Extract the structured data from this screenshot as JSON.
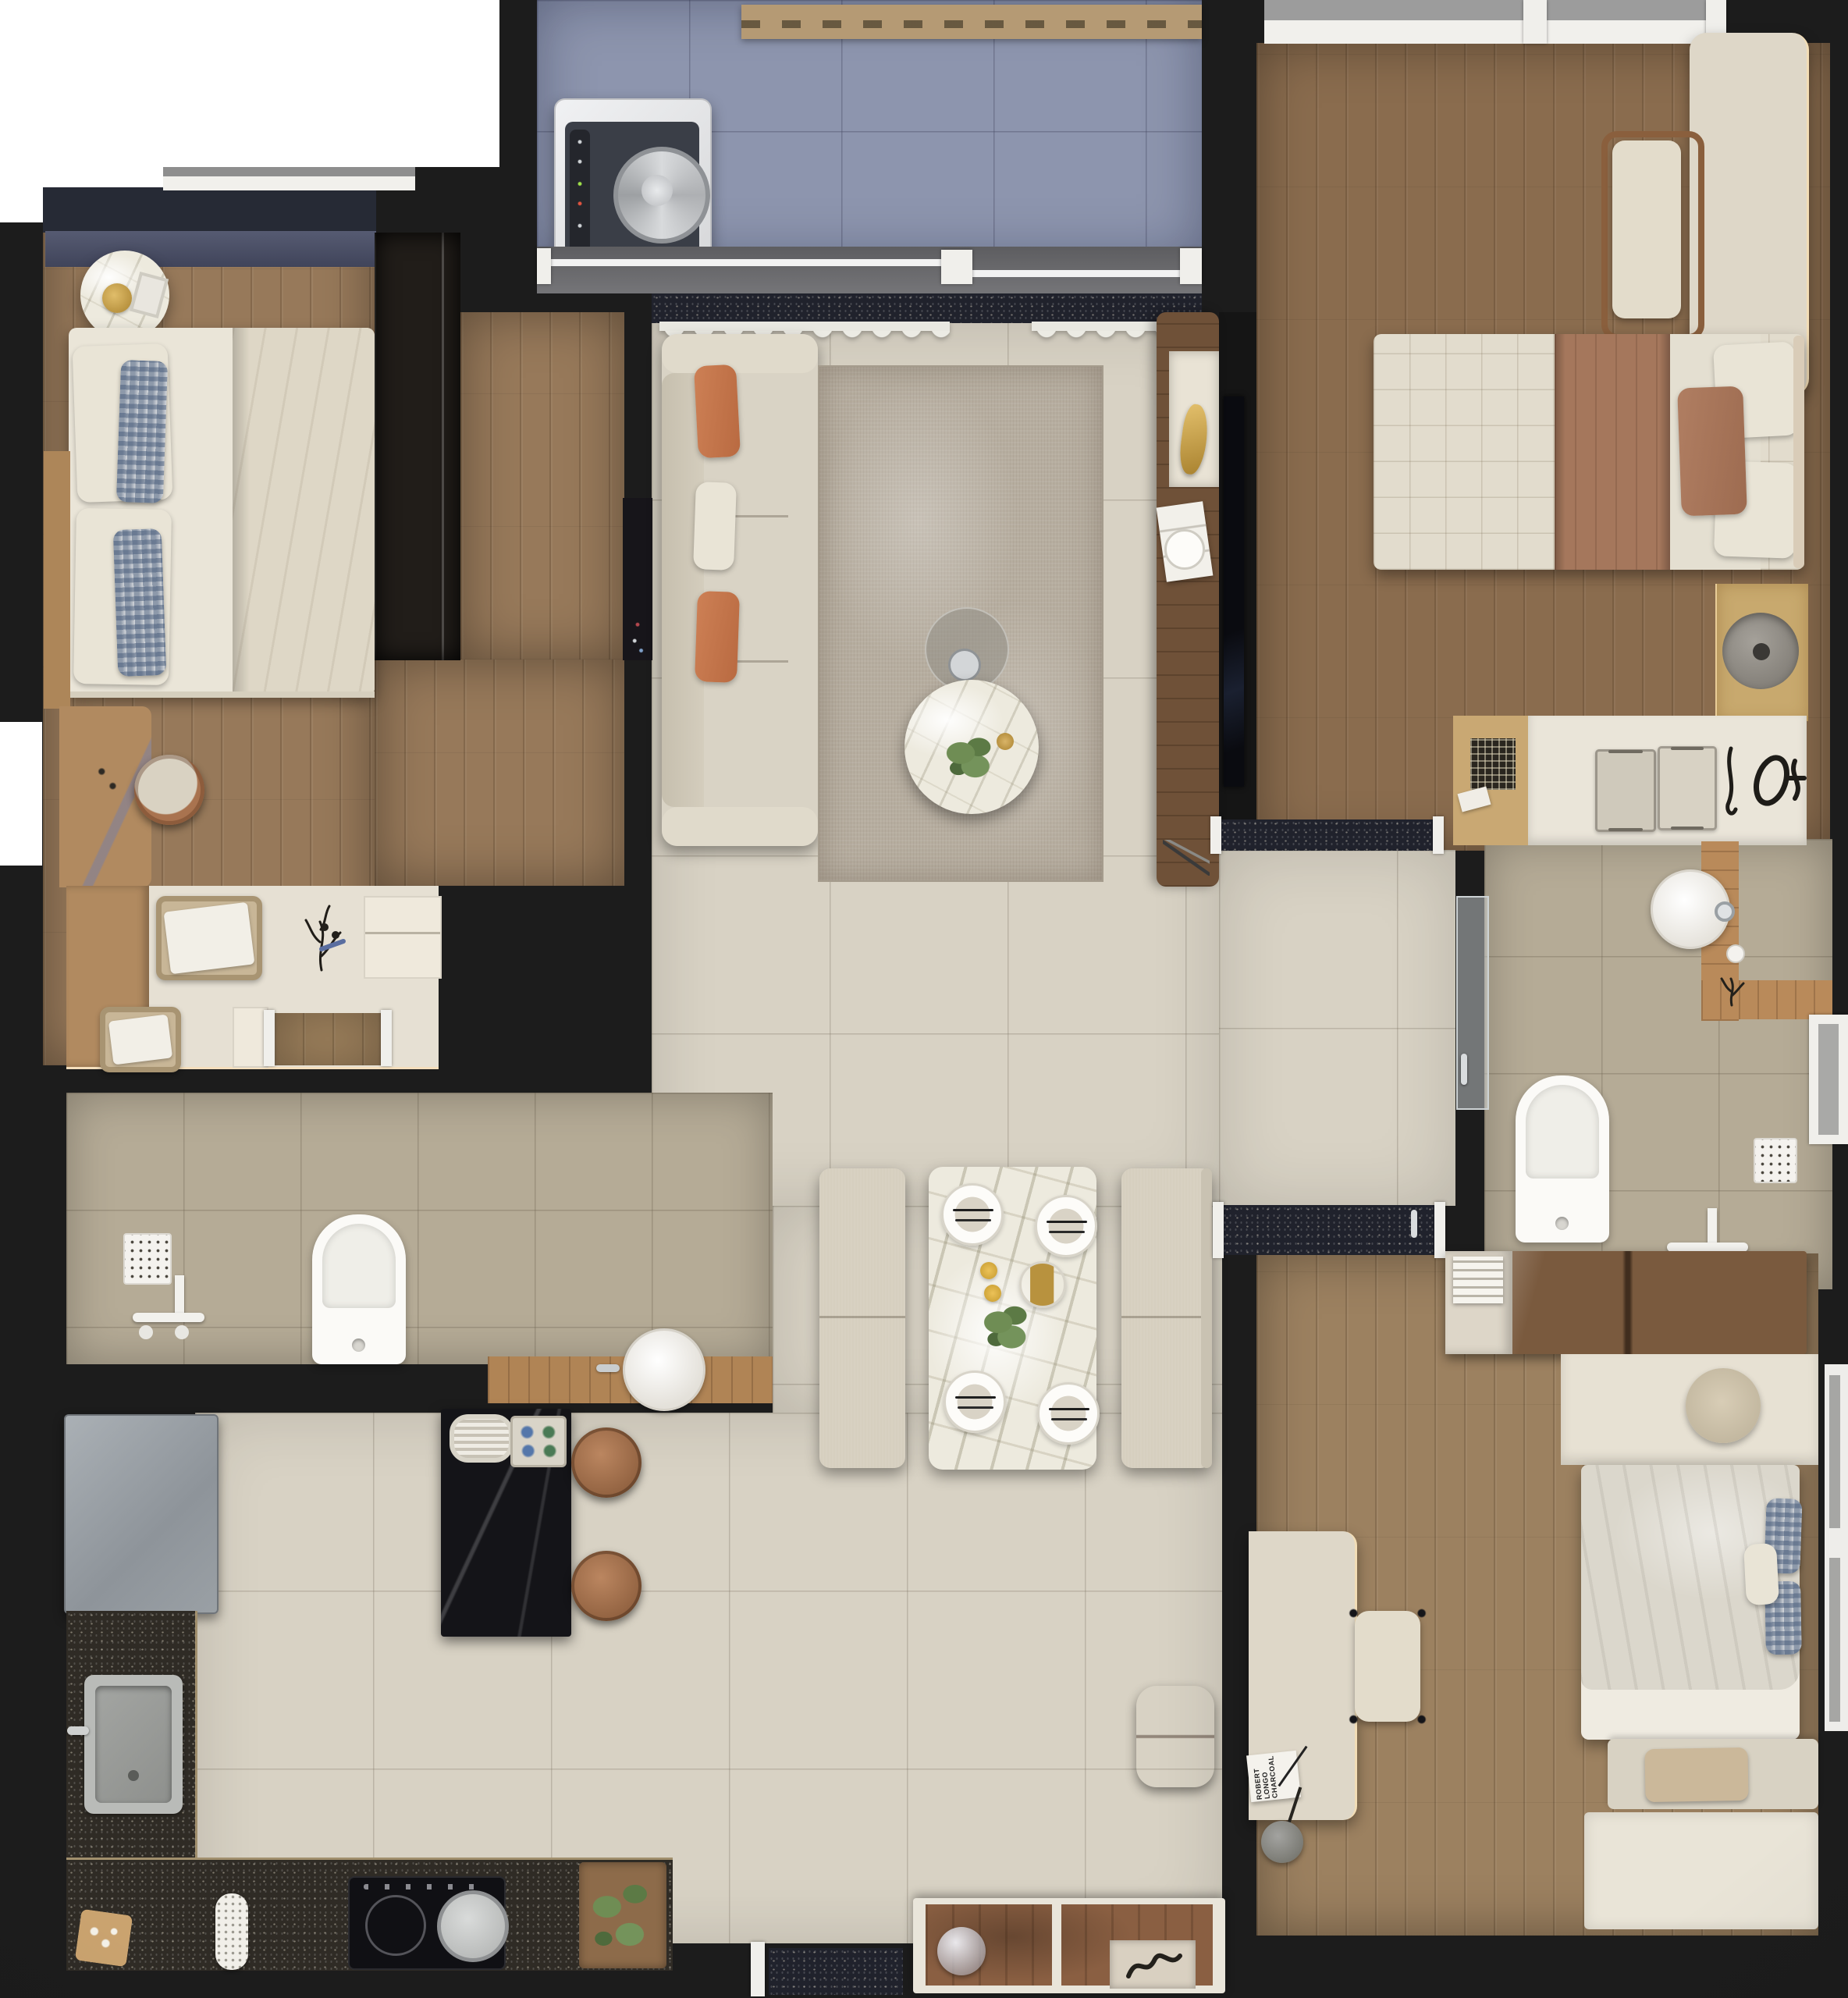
{
  "scene": {
    "type": "apartment-floor-plan-3d-top-view",
    "rooms": [
      "balcony",
      "bedroom-1",
      "living-room",
      "master-bedroom",
      "bathroom-1",
      "bathroom-2",
      "kitchen",
      "dining-area",
      "bedroom-3",
      "entry"
    ]
  },
  "book": {
    "title": "ROBERT LONGO CHARCOAL"
  },
  "palette": {
    "background": "#1c1c1c",
    "white_cutout": "#ffffff",
    "wood_bedroom1": "#97795a",
    "wood_master": "#8a6c4e",
    "wood_bedroom3": "#9c8160",
    "tile_living": "#d8d2c4",
    "tile_bathroom": "#b5ab96",
    "tile_balcony": "#8d95ae",
    "granite_counter": "#2f2b25",
    "threshold_granite": "#20222c",
    "marble_table": "#edeade",
    "sofa_cream": "#d9d3c5",
    "pillow_orange": "#c4764a",
    "blanket_brown": "#a5775c",
    "island_black": "#141418",
    "stool_leather": "#a9734f",
    "rug_taupe": "#b6ad9f",
    "vanity_tan": "#b18a60",
    "counter_gold": "#c8a96e",
    "curtain_white": "#ecebe4",
    "glow_warm": "#f3ddb4"
  }
}
